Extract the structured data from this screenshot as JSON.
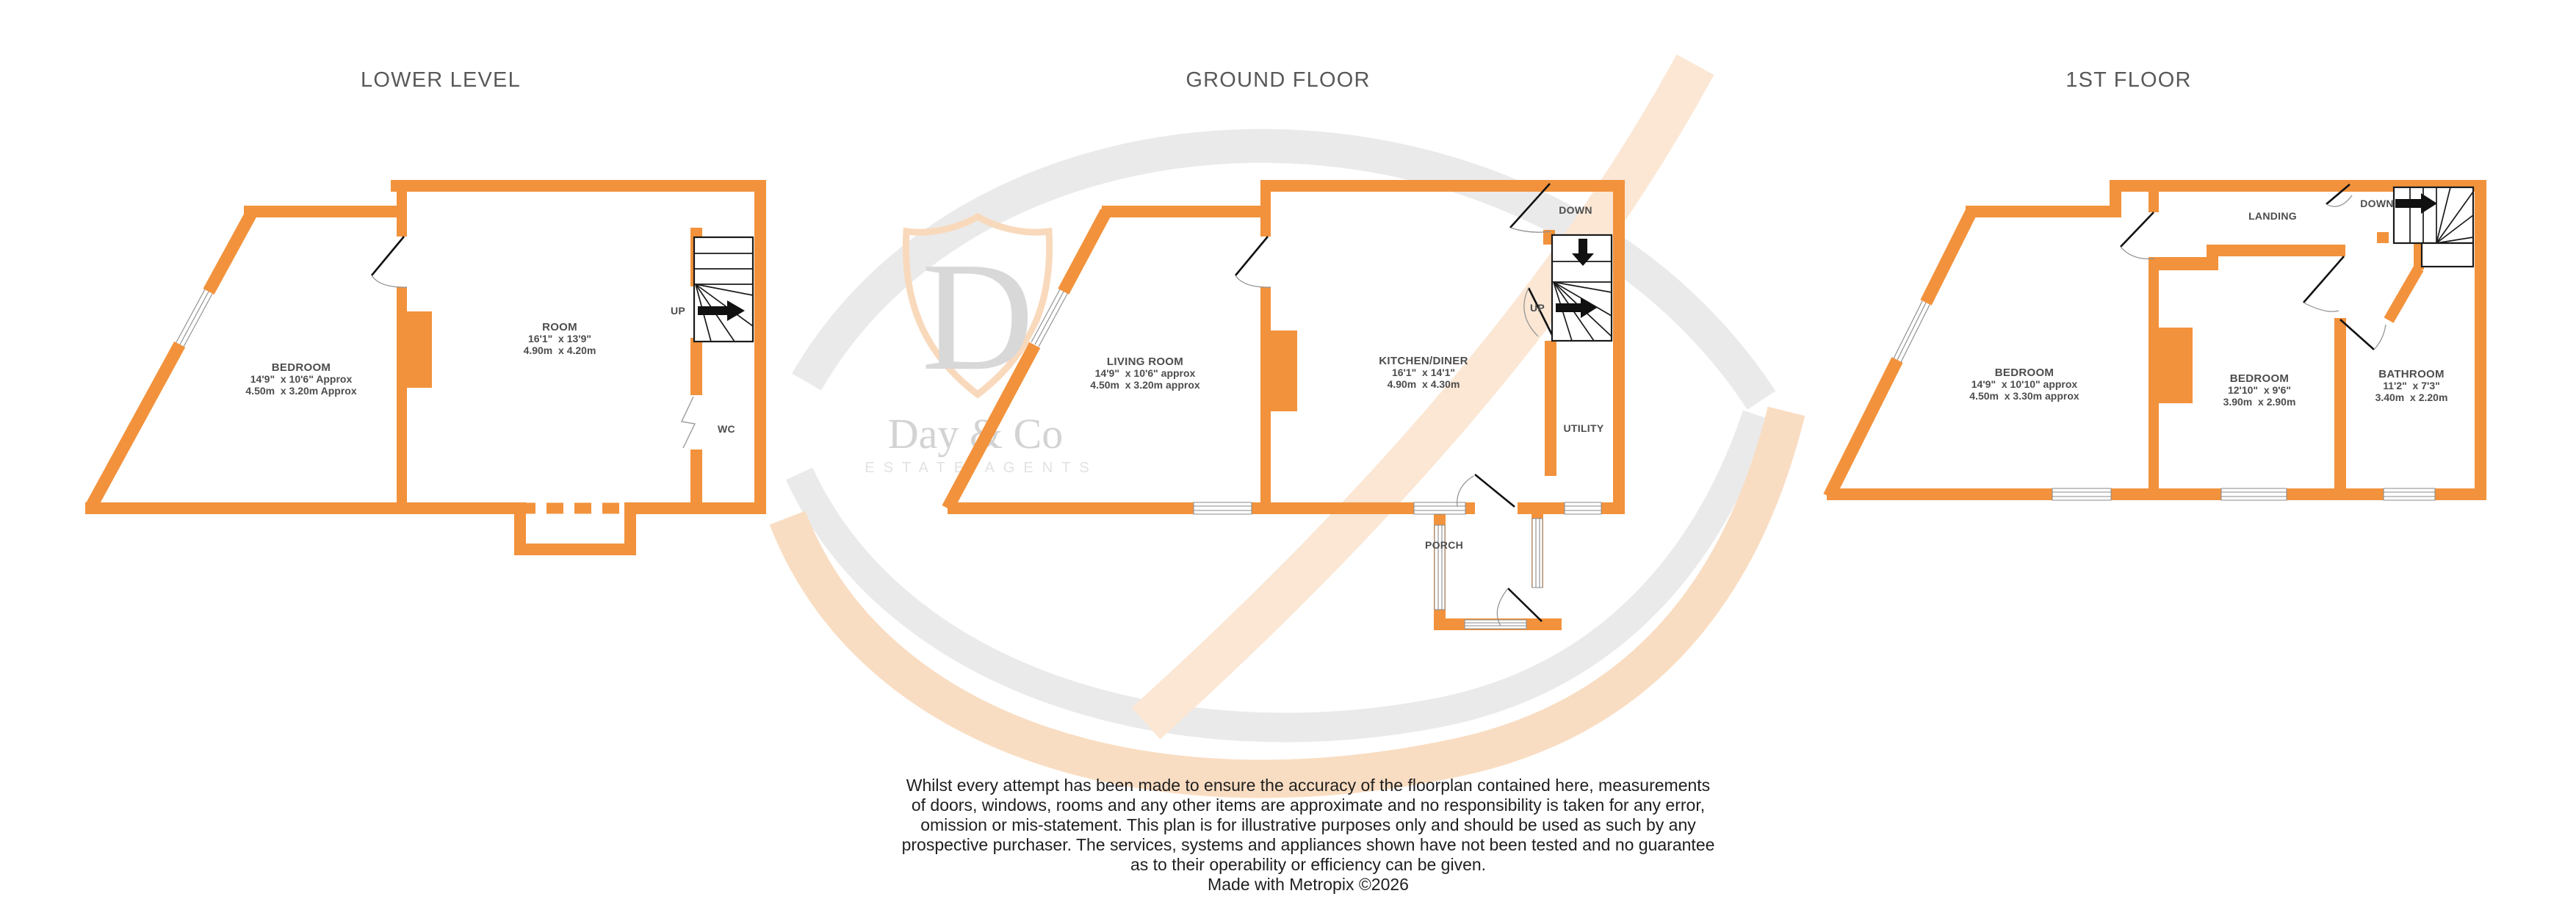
{
  "colors": {
    "wall": "#F2923C",
    "label_text": "#4D4D4D",
    "title_text": "#595959",
    "disclaimer_text": "#1F1F1F",
    "watermark_gray": "#D8D8D8",
    "watermark_orange": "#F9D9BC"
  },
  "floors": {
    "lower": {
      "title": "LOWER LEVEL",
      "bedroom_name": "BEDROOM",
      "bedroom_imperial": "14'9\"  x 10'6\" Approx",
      "bedroom_metric": "4.50m  x 3.20m Approx",
      "room_name": "ROOM",
      "room_imperial": "16'1\"  x 13'9\"",
      "room_metric": "4.90m  x 4.20m",
      "wc": "WC",
      "up": "UP"
    },
    "ground": {
      "title": "GROUND FLOOR",
      "living_name": "LIVING ROOM",
      "living_imperial": "14'9\"  x 10'6\" approx",
      "living_metric": "4.50m  x 3.20m approx",
      "kitchen_name": "KITCHEN/DINER",
      "kitchen_imperial": "16'1\"  x 14'1\"",
      "kitchen_metric": "4.90m  x 4.30m",
      "utility": "UTILITY",
      "porch": "PORCH",
      "up": "UP",
      "down": "DOWN"
    },
    "first": {
      "title": "1ST FLOOR",
      "bedroom1_name": "BEDROOM",
      "bedroom1_imperial": "14'9\"  x 10'10\" approx",
      "bedroom1_metric": "4.50m  x 3.30m approx",
      "bedroom2_name": "BEDROOM",
      "bedroom2_imperial": "12'10\"  x 9'6\"",
      "bedroom2_metric": "3.90m  x 2.90m",
      "bathroom_name": "BATHROOM",
      "bathroom_imperial": "11'2\"  x 7'3\"",
      "bathroom_metric": "3.40m  x 2.20m",
      "landing": "LANDING",
      "down": "DOWN"
    }
  },
  "watermark": {
    "monogram": "D",
    "brand": "Day & Co",
    "tagline": "ESTATE AGENTS"
  },
  "disclaimer": {
    "line1": "Whilst every attempt has been made to ensure the accuracy of the floorplan contained here, measurements",
    "line2": "of doors, windows, rooms and any other items are approximate and no responsibility is taken for any error,",
    "line3": "omission or mis-statement. This plan is for illustrative purposes only and should be used as such by any",
    "line4": "prospective purchaser. The services, systems and appliances shown have not been tested and no guarantee",
    "line5": "as to their operability or efficiency can be given.",
    "credit": "Made with Metropix ©2026"
  }
}
